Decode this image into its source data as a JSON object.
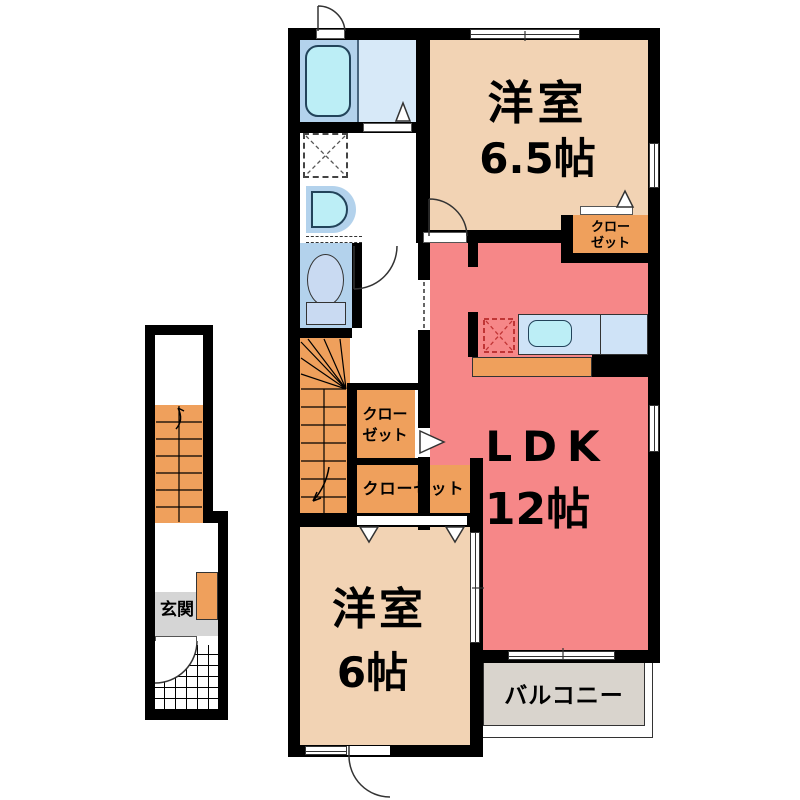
{
  "plan2f": {
    "room_65": {
      "name": "洋室",
      "size": "6.5帖"
    },
    "closet_tr": {
      "line1": "クロー",
      "line2": "ゼット"
    },
    "ldk": {
      "name": "LDK",
      "size": "12帖"
    },
    "closet_hall": {
      "line1": "クロー",
      "line2": "ゼット"
    },
    "closet_wide": {
      "name": "クローゼット"
    },
    "room_6": {
      "name": "洋室",
      "size": "6帖"
    },
    "balcony": {
      "name": "バルコニー"
    }
  },
  "plan1f": {
    "entrance": {
      "name": "玄関"
    }
  },
  "colors": {
    "wall": "#000000",
    "beige": "#f2d3b4",
    "salmon": "#f68788",
    "orange": "#efa05c",
    "roomblue": "#b3d2ec",
    "fixture": "#bceef6",
    "paleblue": "#d7e9f8",
    "counterblue": "#cfe3f7",
    "tankblue": "#c9daf2",
    "balconygray": "#d9d4cd",
    "genkangray": "#d5d5d5"
  }
}
